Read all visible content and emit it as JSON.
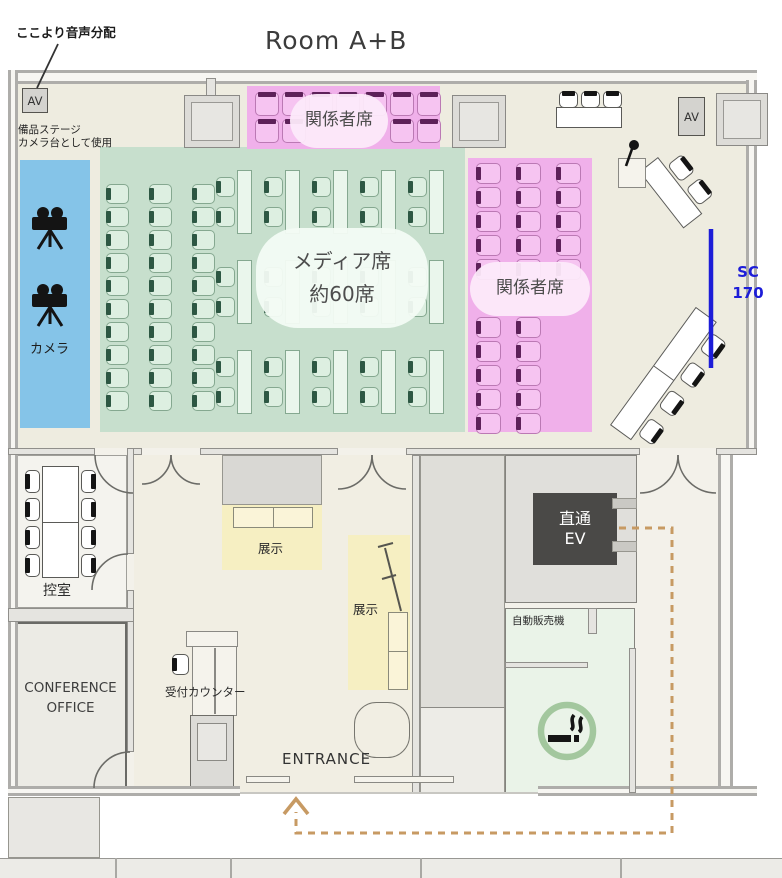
{
  "title": "Room A+B",
  "notes": {
    "audio": "ここより音声分配",
    "stage1": "備品ステージ",
    "stage2": "カメラ台として使用",
    "screen_line1": "SC",
    "screen_line2": "170"
  },
  "labels": {
    "camera": "カメラ",
    "media1": "メディア席",
    "media2": "約60席",
    "vip_top": "関係者席",
    "vip_right": "関係者席",
    "waiting": "控室",
    "office1": "CONFERENCE",
    "office2": "OFFICE",
    "reception": "受付カウンター",
    "exhibit1": "展示",
    "exhibit2": "展示",
    "entrance": "ENTRANCE",
    "ev1": "直通",
    "ev2": "EV",
    "vending": "自動販売機",
    "av_left": "AV",
    "av_right": "AV"
  },
  "colors": {
    "floor": "#eeece0",
    "lower_floor": "#f1eee4",
    "wall_fill": "#e5e4e0",
    "stage_blue": "#85c4e8",
    "media_green": "#c7dfcd",
    "vip_pink": "#f0b0ea",
    "exhibit_yellow": "#f6efc2",
    "smoking_green": "#eaf3e8",
    "ev_dark": "#4a4947",
    "path_tan": "#c79a63",
    "screen_blue": "#1d1dd8"
  },
  "seating": {
    "styles": {
      "green": {
        "fill": "#ddefe1",
        "border": "#85a890",
        "mark": "#2d5743",
        "tableFill": "#eaf6ec"
      },
      "pink": {
        "fill": "#f6c4f1",
        "border": "#bb79b4",
        "mark": "#5d2159",
        "tableFill": "#ffffff"
      },
      "white": {
        "fill": "#ffffff",
        "border": "#5a5a57",
        "mark": "#141414",
        "tableFill": "#ffffff"
      },
      "yellow": {
        "fill": "#fbf6da",
        "border": "#8a8a7a",
        "mark": "#141414",
        "tableFill": "#faf4d8"
      }
    },
    "groups": [
      {
        "name": "media-left-chairs",
        "kind": "grid",
        "style": "green",
        "x": 106,
        "y": 184,
        "cols": 3,
        "rows": 10,
        "dx": 43,
        "dy": 23,
        "w": 23,
        "h": 20,
        "mark": "left"
      },
      {
        "name": "media-table-rows",
        "kind": "tablegrid",
        "style": "green",
        "x": 237,
        "y": 170,
        "cols": 5,
        "rows": 3,
        "dx": 48,
        "dy": 90,
        "tableW": 15,
        "tableH": 64,
        "chairW": 19,
        "chairH": 20,
        "chairOX": -21,
        "chairOY": [
          7,
          37
        ],
        "mark": "left"
      },
      {
        "name": "vip-top-row1",
        "kind": "grid",
        "style": "pink",
        "x": 255,
        "y": 92,
        "cols": 7,
        "rows": 1,
        "dx": 27,
        "dy": 0,
        "w": 24,
        "h": 24,
        "mark": "top"
      },
      {
        "name": "vip-top-row2-left",
        "kind": "grid",
        "style": "pink",
        "x": 255,
        "y": 119,
        "cols": 2,
        "rows": 1,
        "dx": 27,
        "dy": 0,
        "w": 24,
        "h": 24,
        "mark": "top"
      },
      {
        "name": "vip-top-row2-right",
        "kind": "grid",
        "style": "pink",
        "x": 390,
        "y": 119,
        "cols": 2,
        "rows": 1,
        "dx": 27,
        "dy": 0,
        "w": 24,
        "h": 24,
        "mark": "top"
      },
      {
        "name": "vip-right-upper",
        "kind": "grid",
        "style": "pink",
        "x": 476,
        "y": 163,
        "cols": 3,
        "rows": 5,
        "dx": 40,
        "dy": 24,
        "w": 25,
        "h": 21,
        "mark": "left"
      },
      {
        "name": "vip-right-lower",
        "kind": "grid",
        "style": "pink",
        "x": 476,
        "y": 317,
        "cols": 2,
        "rows": 5,
        "dx": 40,
        "dy": 24,
        "w": 25,
        "h": 21,
        "mark": "left"
      },
      {
        "name": "head-table-chairs",
        "kind": "grid",
        "style": "white",
        "x": 559,
        "y": 91,
        "cols": 3,
        "rows": 1,
        "dx": 22,
        "dy": 0,
        "w": 19,
        "h": 17,
        "mark": "top"
      },
      {
        "name": "head-table",
        "kind": "table",
        "style": "white",
        "x": 556,
        "y": 107,
        "w": 66,
        "h": 21
      },
      {
        "name": "waiting-room-chairs-left",
        "kind": "grid",
        "style": "white",
        "x": 25,
        "y": 470,
        "cols": 1,
        "rows": 4,
        "dx": 0,
        "dy": 28,
        "w": 15,
        "h": 23,
        "mark": "left"
      },
      {
        "name": "waiting-room-chairs-right",
        "kind": "grid",
        "style": "white",
        "x": 81,
        "y": 470,
        "cols": 1,
        "rows": 4,
        "dx": 0,
        "dy": 28,
        "w": 15,
        "h": 23,
        "mark": "right"
      },
      {
        "name": "waiting-room-table",
        "kind": "table",
        "style": "white",
        "x": 42,
        "y": 466,
        "w": 37,
        "h": 112,
        "divider": "h"
      },
      {
        "name": "reception-chair",
        "kind": "grid",
        "style": "white",
        "x": 172,
        "y": 654,
        "cols": 1,
        "rows": 1,
        "dx": 0,
        "dy": 0,
        "w": 17,
        "h": 21,
        "mark": "left"
      },
      {
        "name": "exhibit1-tables",
        "kind": "table",
        "style": "yellow",
        "x": 233,
        "y": 507,
        "w": 80,
        "h": 21,
        "divider": "v"
      },
      {
        "name": "exhibit2-table",
        "kind": "table",
        "style": "yellow",
        "x": 388,
        "y": 612,
        "w": 20,
        "h": 78,
        "divider": "h"
      },
      {
        "name": "stage-right-table-upper",
        "kind": "diagonal",
        "style": "white",
        "x": 658,
        "y": 157,
        "angle": 52,
        "tableW": 72,
        "tableH": 24,
        "chairW": 22,
        "chairH": 19,
        "chairX": [
          12,
          42
        ],
        "side": "top"
      },
      {
        "name": "stage-right-table-lower",
        "kind": "diagonal",
        "style": "white",
        "x": 610,
        "y": 425,
        "angle": -54,
        "tableW": 146,
        "tableH": 26,
        "chairW": 22,
        "chairH": 19,
        "chairX": [
          8,
          43,
          78,
          113
        ],
        "side": "bottom",
        "divider": "v"
      }
    ]
  }
}
